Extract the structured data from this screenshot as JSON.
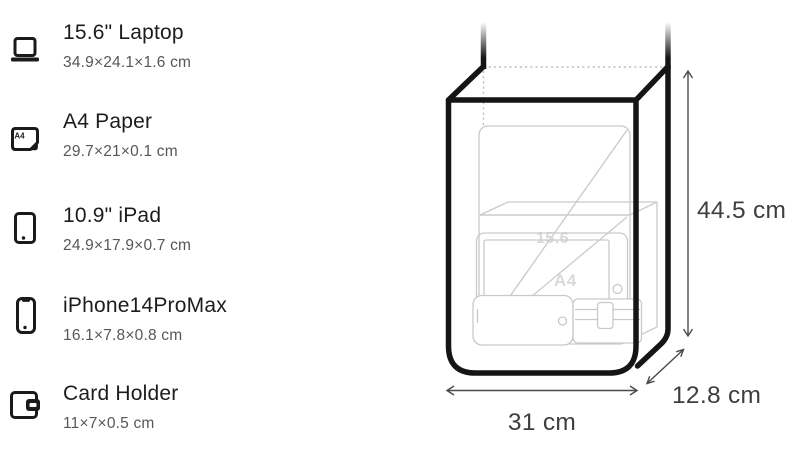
{
  "items": [
    {
      "icon": "laptop-icon",
      "name": "15.6\" Laptop",
      "dimensions": "34.9×24.1×1.6 cm"
    },
    {
      "icon": "a4-paper-icon",
      "name": "A4 Paper",
      "dimensions": "29.7×21×0.1 cm"
    },
    {
      "icon": "ipad-icon",
      "name": "10.9\" iPad",
      "dimensions": "24.9×17.9×0.7 cm"
    },
    {
      "icon": "iphone-icon",
      "name": "iPhone14ProMax",
      "dimensions": "16.1×7.8×0.8 cm"
    },
    {
      "icon": "card-holder-icon",
      "name": "Card Holder",
      "dimensions": "11×7×0.5 cm"
    }
  ],
  "a4_icon_label": "A4",
  "diagram": {
    "height_label": "44.5 cm",
    "width_label": "31 cm",
    "depth_label": "12.8 cm",
    "inner_laptop_label": "15.6",
    "inner_a4_label": "A4"
  },
  "colors": {
    "background": "#ffffff",
    "bag_outline": "#151515",
    "inner_item_outline": "#c9c9cd",
    "dotted_edge": "#bcbcbc",
    "dimension_lines": "#4a4a4a",
    "dimension_text": "#3e3e40",
    "item_title_text": "#1c1c1e",
    "item_dims_text": "#57575a",
    "icon_color": "#1a1a1a"
  }
}
